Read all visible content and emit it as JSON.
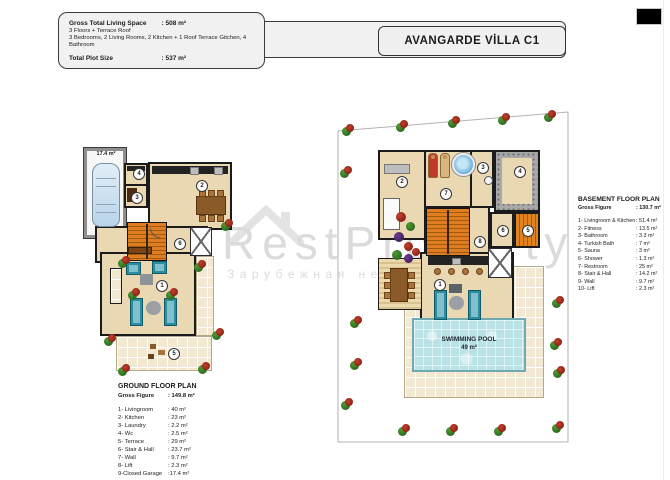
{
  "header": {
    "info": {
      "gross_label": "Gross Total  Living Space",
      "gross_value": ": 508 m²",
      "floors_line": "3 Floors + Terrace Roof",
      "rooms_line": "3 Bedrooms, 2 Living Rooms, 2 Kitchen + 1 Roof Terrace Gitchen, 4 Bathroom",
      "plot_label": "Total Plot Size",
      "plot_value": ": 537 m²"
    },
    "title": "AVANGARDE VİLLA C1"
  },
  "watermark": {
    "brand": "RestProperty",
    "subtitle": "Зарубежная недвижимость"
  },
  "ground_plan": {
    "garage_area": "17.4 m²",
    "room_labels": [
      "1",
      "2",
      "3",
      "4",
      "5",
      "6"
    ]
  },
  "basement_plan": {
    "room_labels": [
      "1",
      "2",
      "3",
      "4",
      "5",
      "6",
      "7",
      "8"
    ],
    "pool_title": "SWIMMING POOL",
    "pool_area": "49 m²"
  },
  "ground_legend": {
    "title": "GROUND FLOOR PLAN",
    "gross_label": "Gross Figure",
    "gross_value": ": 149.8 m²",
    "items": [
      {
        "name": "1- Livingroom",
        "value": ": 40 m²"
      },
      {
        "name": "2- Kitchen",
        "value": ": 23 m²"
      },
      {
        "name": "3- Laundry",
        "value": ": 2.2 m²"
      },
      {
        "name": "4- Wc",
        "value": ": 2.5 m²"
      },
      {
        "name": "5- Terrace",
        "value": ": 29 m²"
      },
      {
        "name": "6- Stair & Hall",
        "value": ": 23.7 m²"
      },
      {
        "name": "7- Wall",
        "value": ": 9.7 m²"
      },
      {
        "name": "8- Lift",
        "value": ": 2.3 m²"
      },
      {
        "name": "9-Closed Garage",
        "value": ":17.4 m²"
      }
    ]
  },
  "basement_legend": {
    "title": "BASEMENT FLOOR PLAN",
    "gross_label": "Gross Figure",
    "gross_value": ": 130.7 m²",
    "items": [
      {
        "name": "1- Livingroom & Kitchen",
        "value": ": 51.4 m²"
      },
      {
        "name": "2- Fitness",
        "value": ": 13.5 m²"
      },
      {
        "name": "3- Bathroom",
        "value": ": 3.3 m²"
      },
      {
        "name": "4- Turkish Bath",
        "value": ": 7 m²"
      },
      {
        "name": "5- Sauna",
        "value": ": 3 m²"
      },
      {
        "name": "6- Shower",
        "value": ": 1.3 m²"
      },
      {
        "name": "7- Restroom",
        "value": ": 25 m²"
      },
      {
        "name": "8- Stair & Hall",
        "value": ": 14.2 m²"
      },
      {
        "name": "9- Wall",
        "value": ": 9.7 m²"
      },
      {
        "name": "10- Lift",
        "value": ": 2.3 m²"
      }
    ]
  },
  "colors": {
    "floor": "#ead8b2",
    "wall": "#1b1b1b",
    "stairs": "#dd7c1e",
    "pool": "#b9e2e6",
    "furniture": "#2a8da0",
    "terrace_tile": "#f3e8d2"
  }
}
